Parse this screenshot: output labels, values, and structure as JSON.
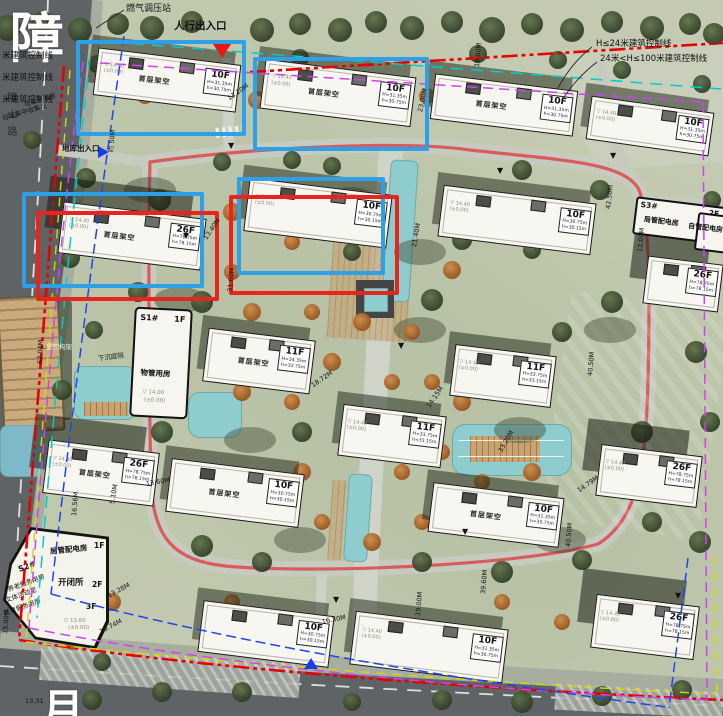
{
  "big_chars": {
    "top_road": "障",
    "bottom_road": "月",
    "road_name": "障山路"
  },
  "legend": {
    "l1": "H≤24米建筑控制线",
    "l2": "24米<H≤100米建筑控制线"
  },
  "entrances": {
    "pedestrian": "人行出入口",
    "garage": "地库出入口",
    "garage_note": "约 50M",
    "gas": "燃气调压站"
  },
  "left_notes": {
    "ctrl1": "米建筑控制线",
    "ctrl2": "米建筑控制线",
    "ctrl3": "米建筑控制线",
    "waste1": "垃圾分类房",
    "waste2": "垃圾集中收集点"
  },
  "landscape": {
    "frame": "景观构架",
    "court": "下沉庭院"
  },
  "s1": {
    "id": "S1#",
    "floor": "1F",
    "room": "物管用房",
    "elev": "▽ 14.00",
    "elev2": "(±0.00)"
  },
  "s3": {
    "id": "S3#",
    "floor": "2F",
    "room": "局管配电房",
    "room2": "自管配电房"
  },
  "s2": {
    "id": "S2#",
    "room_top": "局管配电房",
    "floor_top": "1F",
    "rooms_left": [
      "养老服务用房",
      "文体活动室",
      "托育服务用房"
    ],
    "room_mid": "开闭所",
    "floor_mid": "2F",
    "floor_low": "3F",
    "elev": "▽ 13.60",
    "elev2": "(±0.00)"
  },
  "colors": {
    "highlight_blue": "#2da0e8",
    "highlight_red": "#e8251c",
    "boundary_red": "#e80000",
    "ctrl_magenta": "#cc44ee",
    "ctrl_cyan": "#00cccc",
    "ctrl_blue": "#2244ee",
    "ctrl_yellow": "#d8d800",
    "track_red": "#d95050",
    "water": "#8ecccd"
  },
  "buildings": [
    {
      "x": 95,
      "y": 56,
      "w": 142,
      "h": 46,
      "r": 7,
      "f": "10F",
      "sub": "首层架空",
      "ht": "H=31.35m h=30.75m",
      "elev": "14.40 (±0.00)",
      "tall": false
    },
    {
      "x": 262,
      "y": 68,
      "w": 150,
      "h": 48,
      "r": 7,
      "f": "10F",
      "sub": "首层架空",
      "ht": "H=31.35m h=30.75m",
      "elev": "14.40 (±0.00)",
      "tall": false
    },
    {
      "x": 432,
      "y": 82,
      "w": 142,
      "h": 44,
      "r": 7,
      "f": "10F",
      "sub": "首层架空",
      "ht": "H=31.35m h=30.75m",
      "elev": null,
      "tall": false
    },
    {
      "x": 588,
      "y": 104,
      "w": 122,
      "h": 42,
      "r": 8,
      "f": "10F",
      "sub": null,
      "ht": "H=31.35m h=30.75m",
      "elev": "14.40 (±0.00)",
      "tall": false
    },
    {
      "x": 60,
      "y": 210,
      "w": 142,
      "h": 50,
      "r": 7,
      "f": "26F",
      "sub": "首层架空",
      "ht": "H=78.75m h=78.15m",
      "elev": "14.40 (±0.00)",
      "tall": true
    },
    {
      "x": 246,
      "y": 186,
      "w": 142,
      "h": 52,
      "r": 7,
      "f": "10F",
      "sub": null,
      "ht": "H=30.75m h=30.15m",
      "elev": "14.40 (±0.00)",
      "tall": false
    },
    {
      "x": 440,
      "y": 194,
      "w": 152,
      "h": 50,
      "r": 7,
      "f": "10F",
      "sub": null,
      "ht": "H=30.75m h=30.15m",
      "elev": "14.40 (±0.00)",
      "tall": false
    },
    {
      "x": 645,
      "y": 260,
      "w": 74,
      "h": 46,
      "r": 7,
      "f": "26F",
      "sub": null,
      "ht": "H=78.75m h=78.15m",
      "elev": null,
      "tall": true
    },
    {
      "x": 205,
      "y": 334,
      "w": 106,
      "h": 52,
      "r": 7,
      "f": "11F",
      "sub": "首层架空",
      "ht": "H=34.35m h=33.75m",
      "elev": null,
      "tall": false
    },
    {
      "x": 452,
      "y": 350,
      "w": 100,
      "h": 50,
      "r": 7,
      "f": "11F",
      "sub": null,
      "ht": "H=33.75m h=33.15m",
      "elev": "14.40 (±0.00)",
      "tall": false
    },
    {
      "x": 340,
      "y": 410,
      "w": 102,
      "h": 50,
      "r": 7,
      "f": "11F",
      "sub": null,
      "ht": "H=33.75m h=33.15m",
      "elev": "14.40 (±0.00)",
      "tall": false
    },
    {
      "x": 598,
      "y": 450,
      "w": 100,
      "h": 50,
      "r": 7,
      "f": "26F",
      "sub": null,
      "ht": "H=78.75m h=78.15m",
      "elev": "14.40 (±0.00)",
      "tall": true
    },
    {
      "x": 45,
      "y": 446,
      "w": 110,
      "h": 52,
      "r": 7,
      "f": "26F",
      "sub": "首层架空",
      "ht": "H=78.75m h=78.15m",
      "elev": "14.40 (±0.00)",
      "tall": true
    },
    {
      "x": 168,
      "y": 466,
      "w": 132,
      "h": 52,
      "r": 7,
      "f": "10F",
      "sub": "首层架空",
      "ht": "H=30.75m h=30.15m",
      "elev": null,
      "tall": false
    },
    {
      "x": 430,
      "y": 490,
      "w": 130,
      "h": 48,
      "r": 7,
      "f": "10F",
      "sub": "首层架空",
      "ht": "H=31.35m h=30.75m",
      "elev": null,
      "tall": false
    },
    {
      "x": 200,
      "y": 608,
      "w": 130,
      "h": 50,
      "r": 7,
      "f": "10F",
      "sub": null,
      "ht": "H=30.75m h=30.15m",
      "elev": null,
      "tall": false
    },
    {
      "x": 352,
      "y": 620,
      "w": 152,
      "h": 52,
      "r": 7,
      "f": "10F",
      "sub": null,
      "ht": "H=31.35m h=30.75m",
      "elev": "14.40 (±0.00)",
      "tall": false
    },
    {
      "x": 593,
      "y": 600,
      "w": 102,
      "h": 52,
      "r": 7,
      "f": "26F",
      "sub": null,
      "ht": "H=78.75m h=78.15m",
      "elev": "14.40 (±0.00)",
      "tall": true
    }
  ],
  "dims": [
    {
      "t": "23.00M",
      "x": 420,
      "y": 108,
      "r": -78
    },
    {
      "t": "13.20M",
      "x": 228,
      "y": 95,
      "r": -35
    },
    {
      "t": "19.00M",
      "x": 477,
      "y": 63,
      "r": -85
    },
    {
      "t": "42.50M",
      "x": 608,
      "y": 205,
      "r": -83
    },
    {
      "t": "21.40M",
      "x": 414,
      "y": 243,
      "r": -80
    },
    {
      "t": "13.40M",
      "x": 205,
      "y": 235,
      "r": -55
    },
    {
      "t": "31.60M",
      "x": 230,
      "y": 288,
      "r": -85
    },
    {
      "t": "62.04M",
      "x": 40,
      "y": 360,
      "r": -88
    },
    {
      "t": "12.00M",
      "x": 640,
      "y": 248,
      "r": -85
    },
    {
      "t": "18.72M",
      "x": 312,
      "y": 382,
      "r": -35
    },
    {
      "t": "14.15M",
      "x": 428,
      "y": 403,
      "r": -55
    },
    {
      "t": "40.50M",
      "x": 590,
      "y": 372,
      "r": -85
    },
    {
      "t": "40.50M",
      "x": 568,
      "y": 543,
      "r": -85
    },
    {
      "t": "33.20M",
      "x": 500,
      "y": 448,
      "r": -60
    },
    {
      "t": "14.79M",
      "x": 578,
      "y": 487,
      "r": -35
    },
    {
      "t": "39.60M",
      "x": 483,
      "y": 590,
      "r": -85
    },
    {
      "t": "16.56M",
      "x": 74,
      "y": 512,
      "r": -85
    },
    {
      "t": "5.10M",
      "x": 112,
      "y": 500,
      "r": -80
    },
    {
      "t": "13.60M",
      "x": 146,
      "y": 480,
      "r": -10
    },
    {
      "t": "13.28M",
      "x": 108,
      "y": 592,
      "r": -28
    },
    {
      "t": "10.74M",
      "x": 100,
      "y": 628,
      "r": -28
    },
    {
      "t": "15.00M",
      "x": 5,
      "y": 630,
      "r": -85
    },
    {
      "t": "16.30M",
      "x": 322,
      "y": 618,
      "r": -12
    },
    {
      "t": "19.00M",
      "x": 418,
      "y": 612,
      "r": -85
    },
    {
      "t": "13.31",
      "x": 25,
      "y": 697,
      "r": 0
    }
  ],
  "boxes": [
    {
      "c": "blue",
      "x": 76,
      "y": 40,
      "w": 162,
      "h": 88
    },
    {
      "c": "blue",
      "x": 253,
      "y": 57,
      "w": 168,
      "h": 86
    },
    {
      "c": "blue",
      "x": 237,
      "y": 177,
      "w": 140,
      "h": 90
    },
    {
      "c": "red",
      "x": 229,
      "y": 195,
      "w": 162,
      "h": 92
    },
    {
      "c": "blue",
      "x": 22,
      "y": 192,
      "w": 174,
      "h": 88
    },
    {
      "c": "red",
      "x": 36,
      "y": 211,
      "w": 175,
      "h": 82
    }
  ],
  "markers": [
    {
      "type": "red-down",
      "x": 213,
      "y": 44,
      "label": "pedestrian-entrance"
    },
    {
      "type": "blue-right",
      "x": 98,
      "y": 146,
      "label": "garage-entrance"
    },
    {
      "type": "blue-up",
      "x": 304,
      "y": 658,
      "label": "south-entrance"
    }
  ],
  "flags": [
    [
      398,
      342
    ],
    [
      497,
      167
    ],
    [
      462,
      528
    ],
    [
      333,
      596
    ],
    [
      675,
      592
    ],
    [
      228,
      142
    ],
    [
      183,
      232
    ],
    [
      610,
      152
    ]
  ],
  "decor": {
    "bushes": [
      [
        150,
        190
      ],
      [
        350,
        200
      ],
      [
        550,
        210
      ],
      [
        180,
        300
      ],
      [
        420,
        252
      ],
      [
        610,
        330
      ],
      [
        250,
        440
      ],
      [
        520,
        430
      ],
      [
        300,
        540
      ],
      [
        560,
        540
      ],
      [
        640,
        480
      ],
      [
        420,
        330
      ]
    ],
    "trees_green": [
      [
        8,
        28,
        13
      ],
      [
        42,
        22,
        11
      ],
      [
        80,
        30,
        12
      ],
      [
        118,
        24,
        11
      ],
      [
        152,
        28,
        12
      ],
      [
        192,
        22,
        11
      ],
      [
        262,
        30,
        12
      ],
      [
        300,
        24,
        11
      ],
      [
        340,
        30,
        12
      ],
      [
        376,
        22,
        11
      ],
      [
        412,
        28,
        12
      ],
      [
        452,
        22,
        11
      ],
      [
        492,
        30,
        13
      ],
      [
        532,
        24,
        11
      ],
      [
        572,
        30,
        12
      ],
      [
        612,
        22,
        11
      ],
      [
        652,
        28,
        12
      ],
      [
        690,
        24,
        11
      ],
      [
        714,
        34,
        11
      ],
      [
        97,
        64,
        9
      ],
      [
        300,
        58,
        9
      ],
      [
        478,
        54,
        9
      ],
      [
        558,
        60,
        9
      ],
      [
        622,
        70,
        9
      ],
      [
        702,
        84,
        9
      ],
      [
        86,
        178,
        10
      ],
      [
        70,
        258,
        10
      ],
      [
        94,
        330,
        9
      ],
      [
        62,
        390,
        10
      ],
      [
        80,
        468,
        10
      ],
      [
        56,
        540,
        10
      ],
      [
        76,
        610,
        9
      ],
      [
        102,
        662,
        9
      ],
      [
        700,
        140,
        10
      ],
      [
        712,
        200,
        9
      ],
      [
        696,
        352,
        11
      ],
      [
        710,
        422,
        10
      ],
      [
        700,
        542,
        11
      ],
      [
        160,
        200,
        11
      ],
      [
        222,
        162,
        9
      ],
      [
        292,
        160,
        9
      ],
      [
        332,
        166,
        9
      ],
      [
        522,
        170,
        10
      ],
      [
        600,
        190,
        10
      ],
      [
        138,
        292,
        10
      ],
      [
        202,
        302,
        11
      ],
      [
        432,
        300,
        11
      ],
      [
        612,
        302,
        11
      ],
      [
        162,
        432,
        11
      ],
      [
        302,
        432,
        10
      ],
      [
        562,
        332,
        10
      ],
      [
        642,
        432,
        11
      ],
      [
        202,
        546,
        11
      ],
      [
        262,
        562,
        10
      ],
      [
        422,
        562,
        10
      ],
      [
        502,
        572,
        11
      ],
      [
        582,
        560,
        10
      ],
      [
        652,
        522,
        10
      ],
      [
        92,
        700,
        10
      ],
      [
        162,
        692,
        10
      ],
      [
        242,
        692,
        10
      ],
      [
        352,
        702,
        9
      ],
      [
        442,
        700,
        10
      ],
      [
        522,
        702,
        11
      ],
      [
        602,
        696,
        10
      ],
      [
        682,
        690,
        10
      ],
      [
        32,
        140,
        9
      ],
      [
        462,
        240,
        10
      ],
      [
        532,
        250,
        9
      ],
      [
        352,
        252,
        9
      ]
    ],
    "trees_orange": [
      [
        145,
        96,
        8
      ],
      [
        257,
        100,
        9
      ],
      [
        427,
        96,
        8
      ],
      [
        232,
        212,
        9
      ],
      [
        292,
        242,
        8
      ],
      [
        352,
        232,
        8
      ],
      [
        452,
        270,
        9
      ],
      [
        232,
        272,
        8
      ],
      [
        252,
        312,
        9
      ],
      [
        312,
        312,
        8
      ],
      [
        362,
        322,
        9
      ],
      [
        412,
        332,
        8
      ],
      [
        332,
        362,
        9
      ],
      [
        392,
        382,
        8
      ],
      [
        242,
        392,
        9
      ],
      [
        292,
        402,
        8
      ],
      [
        432,
        382,
        8
      ],
      [
        462,
        402,
        9
      ],
      [
        522,
        392,
        8
      ],
      [
        352,
        422,
        8
      ],
      [
        302,
        472,
        9
      ],
      [
        402,
        472,
        8
      ],
      [
        442,
        452,
        8
      ],
      [
        482,
        482,
        8
      ],
      [
        532,
        472,
        9
      ],
      [
        322,
        522,
        8
      ],
      [
        372,
        542,
        9
      ],
      [
        422,
        522,
        8
      ],
      [
        112,
        602,
        9
      ],
      [
        72,
        642,
        8
      ],
      [
        232,
        602,
        8
      ],
      [
        282,
        632,
        9
      ],
      [
        502,
        602,
        8
      ],
      [
        562,
        622,
        8
      ]
    ]
  }
}
